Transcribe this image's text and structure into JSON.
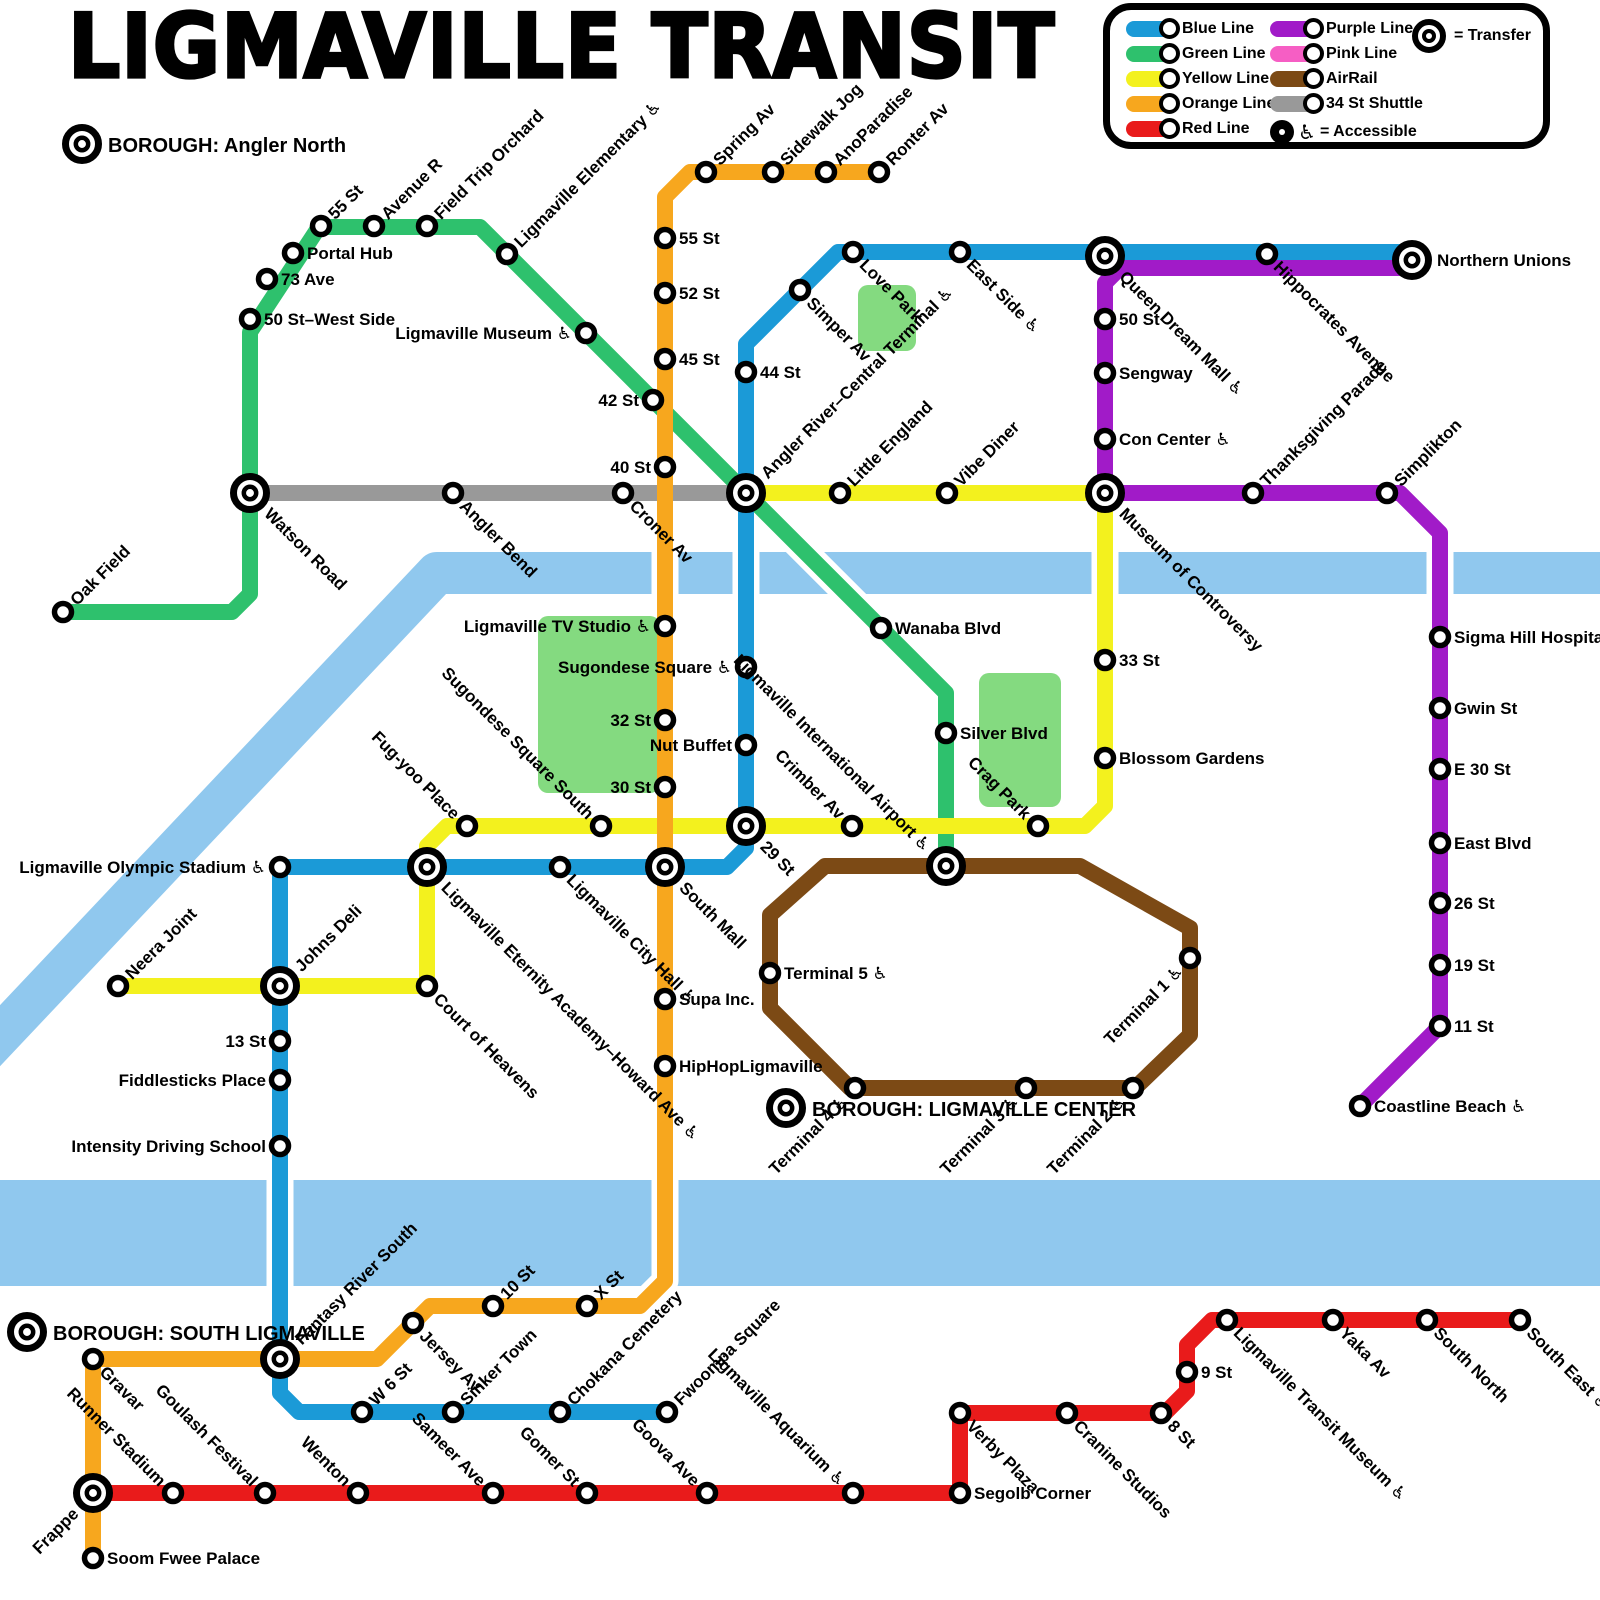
{
  "title": "LIGMAVILLE TRANSIT",
  "legend": {
    "column1": [
      {
        "label": "Blue Line",
        "color": "blue"
      },
      {
        "label": "Green Line",
        "color": "green"
      },
      {
        "label": "Yellow Line",
        "color": "yellow"
      },
      {
        "label": "Orange Line",
        "color": "orange"
      },
      {
        "label": "Red Line",
        "color": "red"
      }
    ],
    "column2": [
      {
        "label": "Purple Line",
        "color": "purple"
      },
      {
        "label": "Pink Line",
        "color": "pink"
      },
      {
        "label": "AirRail",
        "color": "brown"
      },
      {
        "label": "34 St Shuttle",
        "color": "gray"
      }
    ],
    "transfer_label": "= Transfer",
    "accessible_label": "= Accessible",
    "accessible_symbol": "♿"
  },
  "colors": {
    "blue": "#1b9ad7",
    "green": "#2ec16d",
    "yellow": "#f3f11e",
    "orange": "#f7a71e",
    "red": "#e91b1b",
    "purple": "#a11bc8",
    "pink": "#f65ec4",
    "brown": "#7c4a15",
    "gray": "#999999",
    "river": "#90c8ee",
    "park": "#84da80"
  },
  "boroughs": [
    {
      "label": "BOROUGH: Angler North",
      "x": 82,
      "y": 144
    },
    {
      "label": "BOROUGH: LIGMAVILLE CENTER",
      "x": 786,
      "y": 1108
    },
    {
      "label": "BOROUGH: SOUTH LIGMAVILLE",
      "x": 27,
      "y": 1332
    }
  ],
  "map": {
    "rivers": [
      {
        "name": "angler-river",
        "width": 42,
        "points": [
          [
            -40,
            1078
          ],
          [
            437,
            573
          ],
          [
            1610,
            573
          ]
        ]
      },
      {
        "name": "fantasy-river-south",
        "width": 106,
        "points": [
          [
            -20,
            1233
          ],
          [
            1620,
            1233
          ]
        ]
      }
    ],
    "parks": [
      {
        "name": "love-park",
        "x": 858,
        "y": 285,
        "w": 58,
        "h": 66
      },
      {
        "name": "sugondese-square-park",
        "x": 538,
        "y": 616,
        "w": 122,
        "h": 177
      },
      {
        "name": "crag-park",
        "x": 979,
        "y": 673,
        "w": 82,
        "h": 134
      }
    ],
    "lines": [
      {
        "name": "34 St Shuttle",
        "color": "gray",
        "points": [
          [
            250,
            493
          ],
          [
            746,
            493
          ]
        ]
      },
      {
        "name": "Green Line",
        "color": "green",
        "points": [
          [
            63,
            612
          ],
          [
            232,
            612
          ],
          [
            250,
            594
          ],
          [
            250,
            332
          ],
          [
            319,
            227
          ],
          [
            480,
            227
          ],
          [
            946,
            693
          ],
          [
            946,
            866
          ]
        ]
      },
      {
        "name": "Yellow Line",
        "color": "yellow",
        "points": [
          [
            746,
            493
          ],
          [
            1105,
            493
          ],
          [
            1105,
            806
          ],
          [
            1085,
            826
          ],
          [
            447,
            826
          ],
          [
            427,
            846
          ],
          [
            427,
            986
          ],
          [
            118,
            986
          ]
        ]
      },
      {
        "name": "Orange Line",
        "color": "orange",
        "points": [
          [
            879,
            172
          ],
          [
            690,
            172
          ],
          [
            665,
            197
          ],
          [
            665,
            1281
          ],
          [
            640,
            1306
          ],
          [
            430,
            1306
          ],
          [
            377,
            1359
          ],
          [
            93,
            1359
          ],
          [
            93,
            1558
          ]
        ]
      },
      {
        "name": "Blue Line",
        "color": "blue",
        "points": [
          [
            1412,
            252
          ],
          [
            838,
            252
          ],
          [
            746,
            344
          ],
          [
            746,
            848
          ],
          [
            727,
            867
          ],
          [
            280,
            867
          ],
          [
            280,
            1393
          ],
          [
            299,
            1412
          ],
          [
            667,
            1412
          ]
        ]
      },
      {
        "name": "Purple Line",
        "color": "purple",
        "points": [
          [
            1412,
            268
          ],
          [
            1120,
            268
          ],
          [
            1105,
            283
          ],
          [
            1105,
            493
          ],
          [
            1400,
            493
          ],
          [
            1440,
            533
          ],
          [
            1440,
            1026
          ],
          [
            1360,
            1106
          ]
        ]
      },
      {
        "name": "AirRail",
        "color": "brown",
        "closed": true,
        "points": [
          [
            825,
            866
          ],
          [
            1080,
            866
          ],
          [
            1190,
            928
          ],
          [
            1190,
            1035
          ],
          [
            1135,
            1088
          ],
          [
            850,
            1088
          ],
          [
            770,
            1008
          ],
          [
            770,
            915
          ]
        ]
      },
      {
        "name": "Red Line",
        "color": "red",
        "points": [
          [
            93,
            1493
          ],
          [
            960,
            1493
          ],
          [
            960,
            1413
          ],
          [
            1165,
            1413
          ],
          [
            1187,
            1391
          ],
          [
            1187,
            1345
          ],
          [
            1212,
            1320
          ],
          [
            1520,
            1320
          ]
        ]
      }
    ],
    "stations": [
      {
        "n": "Oak Field",
        "x": 63,
        "y": 612,
        "r": -45,
        "a": "s"
      },
      {
        "n": "Watson Road",
        "x": 250,
        "y": 493,
        "tr": 1,
        "r": 45,
        "a": "s"
      },
      {
        "n": "50 St–West Side",
        "x": 250,
        "y": 319,
        "r": 0,
        "a": "s"
      },
      {
        "n": "73 Ave",
        "x": 267,
        "y": 279,
        "r": 0,
        "a": "s"
      },
      {
        "n": "Portal Hub",
        "x": 293,
        "y": 253,
        "r": 0,
        "a": "s"
      },
      {
        "n": "55 St",
        "x": 321,
        "y": 226,
        "r": -45,
        "a": "s"
      },
      {
        "n": "Avenue R",
        "x": 374,
        "y": 226,
        "r": -45,
        "a": "s"
      },
      {
        "n": "Field Trip Orchard",
        "x": 427,
        "y": 226,
        "r": -45,
        "a": "s"
      },
      {
        "n": "Ligmaville Elementary",
        "acc": 1,
        "x": 507,
        "y": 254,
        "r": -45,
        "a": "s"
      },
      {
        "n": "Ligmaville Museum",
        "acc": 1,
        "x": 586,
        "y": 333,
        "r": 0,
        "a": "e"
      },
      {
        "n": "42 St",
        "x": 653,
        "y": 400,
        "r": 0,
        "a": "e"
      },
      {
        "n": "Angler River–Central Terminal",
        "acc": 1,
        "x": 746,
        "y": 493,
        "tr": 1,
        "r": -45,
        "a": "s"
      },
      {
        "n": "Wanaba Blvd",
        "x": 881,
        "y": 628,
        "r": 0,
        "a": "s"
      },
      {
        "n": "Silver Blvd",
        "x": 946,
        "y": 733,
        "r": 0,
        "a": "s"
      },
      {
        "n": "Angler Bend",
        "x": 453,
        "y": 493,
        "r": 45,
        "a": "s"
      },
      {
        "n": "Croner Av",
        "x": 623,
        "y": 493,
        "r": 45,
        "a": "s"
      },
      {
        "n": "Ronter Av",
        "x": 879,
        "y": 172,
        "r": -45,
        "a": "s"
      },
      {
        "n": "AnoParadise",
        "x": 826,
        "y": 172,
        "r": -45,
        "a": "s"
      },
      {
        "n": "Sidewalk Jog",
        "x": 773,
        "y": 172,
        "r": -45,
        "a": "s"
      },
      {
        "n": "Spring Av",
        "x": 706,
        "y": 172,
        "r": -45,
        "a": "s"
      },
      {
        "n": "55 St",
        "x": 665,
        "y": 238,
        "r": 0,
        "a": "s"
      },
      {
        "n": "52 St",
        "x": 665,
        "y": 293,
        "r": 0,
        "a": "s"
      },
      {
        "n": "45 St",
        "x": 665,
        "y": 359,
        "r": 0,
        "a": "s"
      },
      {
        "n": "40 St",
        "x": 665,
        "y": 467,
        "r": 0,
        "a": "e"
      },
      {
        "n": "Ligmaville TV Studio",
        "acc": 1,
        "x": 665,
        "y": 626,
        "r": 0,
        "a": "e"
      },
      {
        "n": "32 St",
        "x": 665,
        "y": 720,
        "r": 0,
        "a": "e"
      },
      {
        "n": "30 St",
        "x": 665,
        "y": 787,
        "r": 0,
        "a": "e"
      },
      {
        "n": "South Mall",
        "x": 665,
        "y": 867,
        "tr": 1,
        "r": 45,
        "a": "s"
      },
      {
        "n": "Supa Inc.",
        "x": 665,
        "y": 999,
        "r": 0,
        "a": "s"
      },
      {
        "n": "HipHopLigmaville",
        "x": 665,
        "y": 1066,
        "r": 0,
        "a": "s"
      },
      {
        "n": "X St",
        "x": 587,
        "y": 1306,
        "r": -45,
        "a": "s"
      },
      {
        "n": "10 St",
        "x": 493,
        "y": 1306,
        "r": -45,
        "a": "s"
      },
      {
        "n": "Jersey Av",
        "x": 413,
        "y": 1323,
        "r": 45,
        "a": "s"
      },
      {
        "n": "Fantasy River South",
        "x": 280,
        "y": 1359,
        "tr": 1,
        "r": -45,
        "a": "s"
      },
      {
        "n": "Gravar",
        "x": 93,
        "y": 1359,
        "r": 45,
        "a": "s"
      },
      {
        "n": "Frappe",
        "x": 93,
        "y": 1493,
        "tr": 1,
        "r": -45,
        "a": "e"
      },
      {
        "n": "Soom Fwee Palace",
        "x": 93,
        "y": 1558,
        "r": 0,
        "a": "s"
      },
      {
        "n": "Northern Unions",
        "x": 1412,
        "y": 260,
        "tr": 1,
        "r": 0,
        "a": "s"
      },
      {
        "n": "Hippocrates Avenue",
        "x": 1267,
        "y": 254,
        "r": 45,
        "a": "s"
      },
      {
        "n": "Queen Dream Mall",
        "acc": 1,
        "x": 1105,
        "y": 256,
        "tr": 1,
        "r": 45,
        "a": "s"
      },
      {
        "n": "East Side",
        "acc": 1,
        "x": 960,
        "y": 252,
        "r": 45,
        "a": "s"
      },
      {
        "n": "Love Park",
        "x": 853,
        "y": 252,
        "r": 45,
        "a": "s"
      },
      {
        "n": "Simper Av",
        "x": 800,
        "y": 290,
        "r": 45,
        "a": "s"
      },
      {
        "n": "44 St",
        "x": 746,
        "y": 372,
        "r": 0,
        "a": "s"
      },
      {
        "n": "Sugondese Square",
        "acc": 1,
        "x": 746,
        "y": 667,
        "r": 0,
        "a": "e"
      },
      {
        "n": "Nut Buffet",
        "x": 746,
        "y": 745,
        "r": 0,
        "a": "e"
      },
      {
        "n": "29 St",
        "x": 746,
        "y": 826,
        "tr": 1,
        "r": 45,
        "a": "s"
      },
      {
        "n": "Ligmaville City Hall",
        "acc": 1,
        "x": 560,
        "y": 867,
        "r": 45,
        "a": "s"
      },
      {
        "n": "Ligmaville Eternity Academy–Howard Ave",
        "acc": 1,
        "x": 427,
        "y": 867,
        "tr": 1,
        "r": 45,
        "a": "s"
      },
      {
        "n": "Ligmaville Olympic Stadium",
        "acc": 1,
        "x": 280,
        "y": 867,
        "r": 0,
        "a": "e"
      },
      {
        "n": "Johns Deli",
        "x": 280,
        "y": 986,
        "tr": 1,
        "r": -45,
        "a": "s"
      },
      {
        "n": "13 St",
        "x": 280,
        "y": 1041,
        "r": 0,
        "a": "e"
      },
      {
        "n": "Fiddlesticks Place",
        "x": 280,
        "y": 1080,
        "r": 0,
        "a": "e"
      },
      {
        "n": "Intensity Driving School",
        "x": 280,
        "y": 1146,
        "r": 0,
        "a": "e"
      },
      {
        "n": "W 6 St",
        "x": 362,
        "y": 1412,
        "r": -45,
        "a": "s"
      },
      {
        "n": "Sinker Town",
        "x": 453,
        "y": 1412,
        "r": -45,
        "a": "s"
      },
      {
        "n": "Chokana Cemetery",
        "x": 560,
        "y": 1412,
        "r": -45,
        "a": "s"
      },
      {
        "n": "Fwoompa Square",
        "x": 667,
        "y": 1412,
        "r": -45,
        "a": "s"
      },
      {
        "n": "Little England",
        "x": 840,
        "y": 493,
        "r": -45,
        "a": "s"
      },
      {
        "n": "Vibe Diner",
        "x": 947,
        "y": 493,
        "r": -45,
        "a": "s"
      },
      {
        "n": "Museum of Controversy",
        "x": 1105,
        "y": 493,
        "tr": 1,
        "r": 45,
        "a": "s"
      },
      {
        "n": "33 St",
        "x": 1105,
        "y": 660,
        "r": 0,
        "a": "s"
      },
      {
        "n": "Blossom Gardens",
        "x": 1105,
        "y": 758,
        "r": 0,
        "a": "s"
      },
      {
        "n": "Crag Park",
        "x": 1038,
        "y": 826,
        "r": 45,
        "a": "e"
      },
      {
        "n": "Crimber Av",
        "x": 852,
        "y": 826,
        "r": 45,
        "a": "e"
      },
      {
        "n": "Ligmaville International Airport",
        "acc": 1,
        "x": 946,
        "y": 866,
        "tr": 1,
        "r": 45,
        "a": "e"
      },
      {
        "n": "Sugondese Square South",
        "x": 601,
        "y": 826,
        "r": 45,
        "a": "e"
      },
      {
        "n": "Fug-yoo Place",
        "x": 467,
        "y": 826,
        "r": 45,
        "a": "e"
      },
      {
        "n": "Court of Heavens",
        "x": 427,
        "y": 986,
        "r": 45,
        "a": "s"
      },
      {
        "n": "Neera Joint",
        "x": 118,
        "y": 986,
        "r": -45,
        "a": "s"
      },
      {
        "n": "50 St",
        "x": 1105,
        "y": 319,
        "r": 0,
        "a": "s"
      },
      {
        "n": "Sengway",
        "x": 1105,
        "y": 373,
        "r": 0,
        "a": "s"
      },
      {
        "n": "Con Center",
        "acc": 1,
        "x": 1105,
        "y": 439,
        "r": 0,
        "a": "s"
      },
      {
        "n": "Thanksgiving Parade",
        "x": 1253,
        "y": 493,
        "r": -45,
        "a": "s"
      },
      {
        "n": "Simplikton",
        "x": 1387,
        "y": 493,
        "r": -45,
        "a": "s"
      },
      {
        "n": "Sigma Hill Hospital",
        "x": 1440,
        "y": 637,
        "r": 0,
        "a": "s"
      },
      {
        "n": "Gwin St",
        "x": 1440,
        "y": 708,
        "r": 0,
        "a": "s"
      },
      {
        "n": "E 30 St",
        "x": 1440,
        "y": 769,
        "r": 0,
        "a": "s"
      },
      {
        "n": "East Blvd",
        "x": 1440,
        "y": 843,
        "r": 0,
        "a": "s"
      },
      {
        "n": "26 St",
        "x": 1440,
        "y": 903,
        "r": 0,
        "a": "s"
      },
      {
        "n": "19 St",
        "x": 1440,
        "y": 965,
        "r": 0,
        "a": "s"
      },
      {
        "n": "11 St",
        "x": 1440,
        "y": 1026,
        "r": 0,
        "a": "s"
      },
      {
        "n": "Coastline Beach",
        "acc": 1,
        "x": 1360,
        "y": 1106,
        "r": 0,
        "a": "s"
      },
      {
        "n": "Terminal 5",
        "acc": 1,
        "x": 770,
        "y": 973,
        "r": 0,
        "a": "s"
      },
      {
        "n": "Terminal 4",
        "acc": 1,
        "x": 855,
        "y": 1088,
        "r": -45,
        "a": "e"
      },
      {
        "n": "Terminal 3",
        "acc": 1,
        "x": 1026,
        "y": 1088,
        "r": -45,
        "a": "e"
      },
      {
        "n": "Terminal 2",
        "acc": 1,
        "x": 1133,
        "y": 1088,
        "r": -45,
        "a": "e"
      },
      {
        "n": "Terminal 1",
        "acc": 1,
        "x": 1190,
        "y": 958,
        "r": -45,
        "a": "e"
      },
      {
        "n": "Runner Stadium",
        "x": 173,
        "y": 1493,
        "r": 45,
        "a": "e"
      },
      {
        "n": "Goulash Festival",
        "x": 265,
        "y": 1493,
        "r": 45,
        "a": "e"
      },
      {
        "n": "Wenton",
        "x": 358,
        "y": 1493,
        "r": 45,
        "a": "e"
      },
      {
        "n": "Sameer Ave",
        "x": 493,
        "y": 1493,
        "r": 45,
        "a": "e"
      },
      {
        "n": "Gomer St",
        "x": 587,
        "y": 1493,
        "r": 45,
        "a": "e"
      },
      {
        "n": "Goova Ave",
        "x": 707,
        "y": 1493,
        "r": 45,
        "a": "e"
      },
      {
        "n": "Ligmaville Aquarium",
        "acc": 1,
        "x": 853,
        "y": 1493,
        "r": 45,
        "a": "e"
      },
      {
        "n": "Segolb Corner",
        "x": 960,
        "y": 1493,
        "r": 0,
        "a": "s"
      },
      {
        "n": "Verby Plaza",
        "x": 960,
        "y": 1413,
        "r": 45,
        "a": "s"
      },
      {
        "n": "Cranine Studios",
        "x": 1067,
        "y": 1413,
        "r": 45,
        "a": "s"
      },
      {
        "n": "8 St",
        "x": 1161,
        "y": 1413,
        "r": 45,
        "a": "s"
      },
      {
        "n": "9 St",
        "x": 1187,
        "y": 1372,
        "r": 0,
        "a": "s"
      },
      {
        "n": "Ligmaville Transit Museum",
        "acc": 1,
        "x": 1227,
        "y": 1320,
        "r": 45,
        "a": "s"
      },
      {
        "n": "Yaka Av",
        "x": 1333,
        "y": 1320,
        "r": 45,
        "a": "s"
      },
      {
        "n": "South North",
        "x": 1427,
        "y": 1320,
        "r": 45,
        "a": "s"
      },
      {
        "n": "South East",
        "acc": 1,
        "x": 1520,
        "y": 1320,
        "r": 45,
        "a": "s"
      }
    ]
  }
}
